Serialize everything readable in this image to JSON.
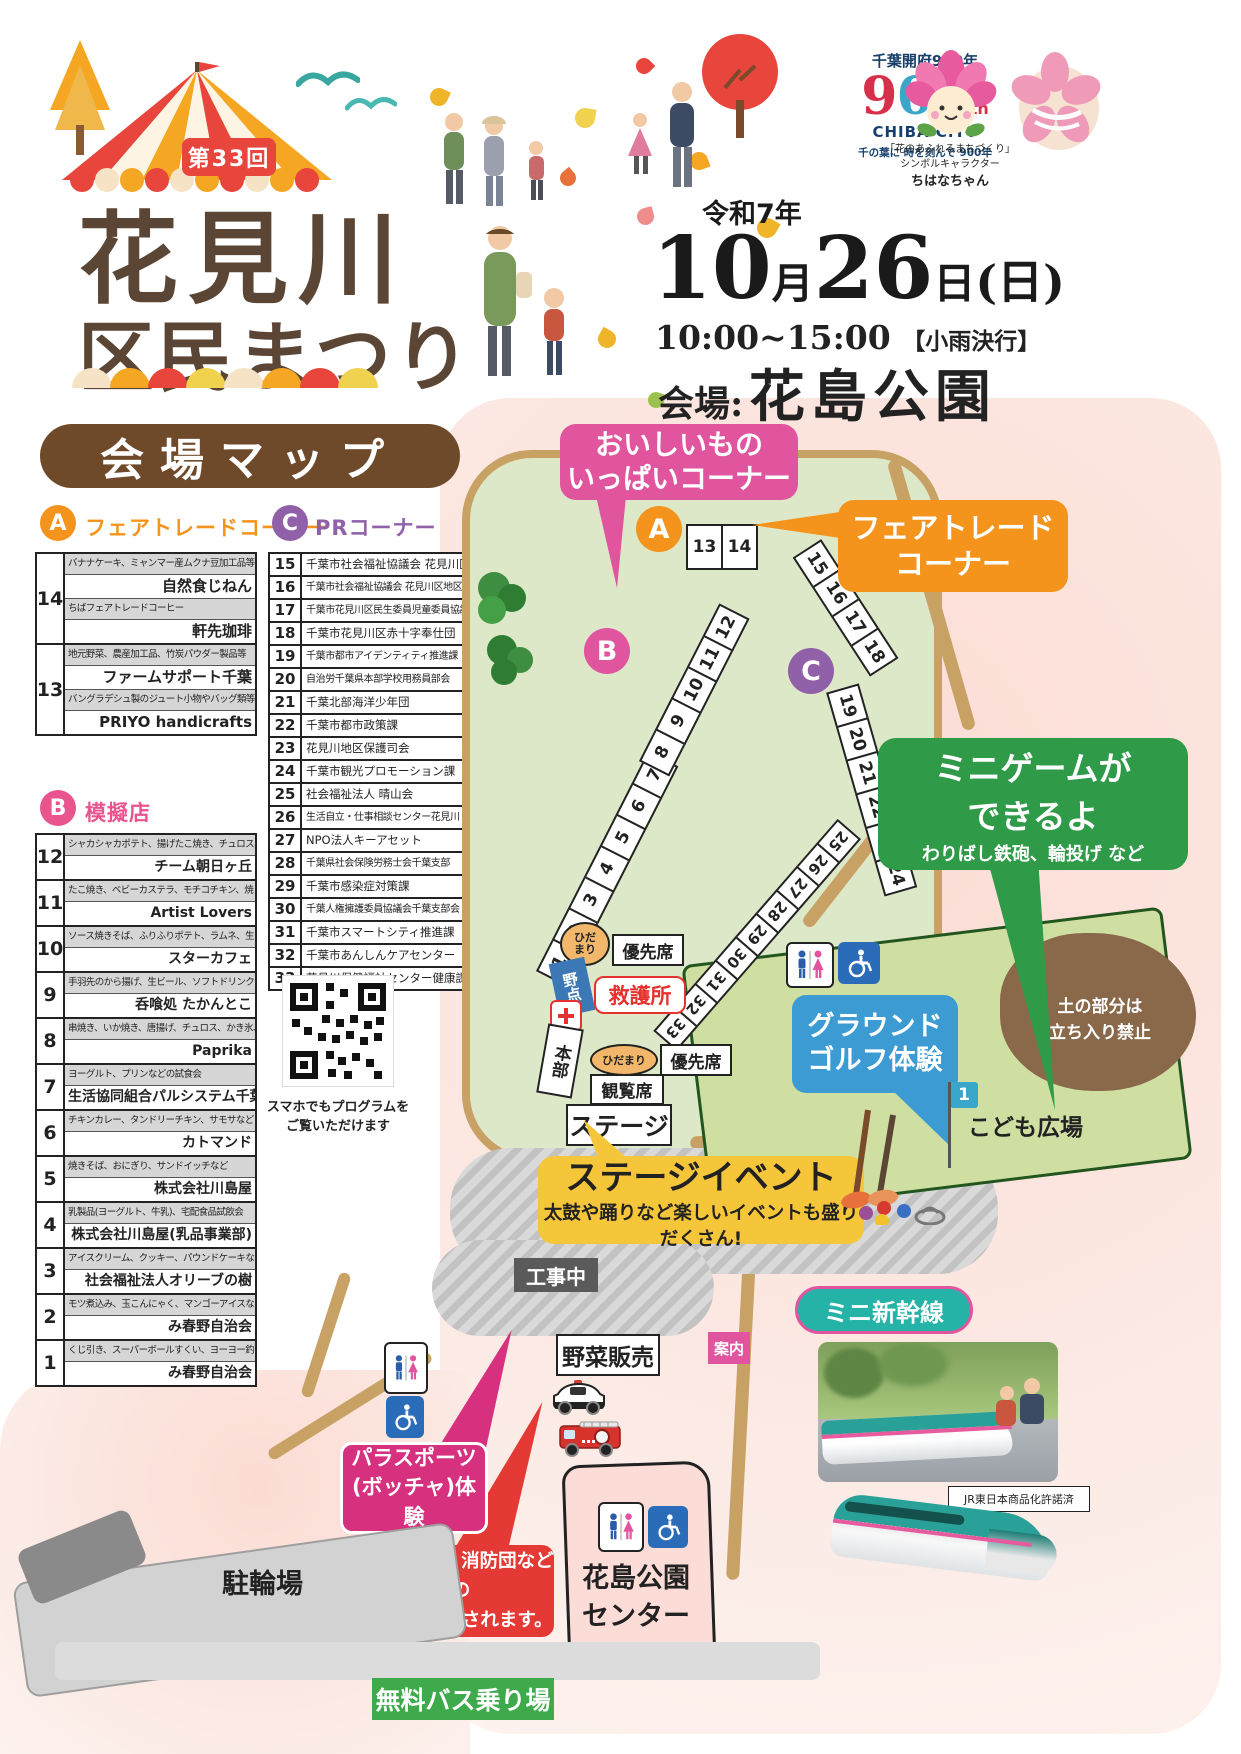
{
  "header": {
    "edition_badge": "第33回",
    "title_line1": "花見川",
    "title_line2": "区民まつり",
    "era_year": "令和7年",
    "date_month": "10",
    "month_unit": "月",
    "date_day": "26",
    "day_unit": "日",
    "weekday": "(日)",
    "time": "10:00~15:00",
    "time_note": "【小雨決行】",
    "venue_prefix": "会場:",
    "venue_name": "花島公園",
    "chiba900": {
      "line1": "千葉開府900年",
      "nine": "9",
      "zero1": "0",
      "zero2": "0",
      "th": "th",
      "city": "CHIBA CITY",
      "tagline": "千の葉に 時を刻んで 900年"
    },
    "mascot": {
      "caption1": "「花のあふれるまちづくり」",
      "caption2": "シンボルキャラクター",
      "name": "ちはなちゃん"
    }
  },
  "map_title": "会場マップ",
  "section_a": {
    "badge": "A",
    "title": "フェアトレードコーナー",
    "rows": [
      {
        "no": "14",
        "desc1": "バナナケーキ、ミャンマー産ムクナ豆加工品等",
        "name1": "自然食じねん",
        "desc2": "ちばフェアトレードコーヒー",
        "name2": "軒先珈琲"
      },
      {
        "no": "13",
        "desc1": "地元野菜、農産加工品、竹炭パウダー製品等",
        "name1": "ファームサポート千葉",
        "desc2": "バングラデシュ製のジュート小物やバッグ類等",
        "name2": "PRIYO handicrafts"
      }
    ]
  },
  "section_b": {
    "badge": "B",
    "title": "模擬店",
    "rows": [
      {
        "no": "12",
        "desc": "シャカシャカポテト、揚げたこ焼き、チュロス、焼きそばなど",
        "name": "チーム朝日ヶ丘"
      },
      {
        "no": "11",
        "desc": "たこ焼き、ベビーカステラ、モチコチキン、焼き鳥など",
        "name": "Artist Lovers"
      },
      {
        "no": "10",
        "desc": "ソース焼きそば、ふりふりポテト、ラムネ、生ビールなど",
        "name": "スターカフェ"
      },
      {
        "no": "9",
        "desc": "手羽先のから揚げ、生ビール、ソフトドリンクなど",
        "name": "呑喰処 たかんとこ"
      },
      {
        "no": "8",
        "desc": "串焼き、いか焼き、唐揚げ、チュロス、かき氷、綿菓子など",
        "name": "Paprika"
      },
      {
        "no": "7",
        "desc": "ヨーグルト、プリンなどの試食会",
        "name": "生活協同組合パルシステム千葉"
      },
      {
        "no": "6",
        "desc": "チキンカレー、タンドリーチキン、サモサなど",
        "name": "カトマンド"
      },
      {
        "no": "5",
        "desc": "焼きそば、おにぎり、サンドイッチなど",
        "name": "株式会社川島屋"
      },
      {
        "no": "4",
        "desc": "乳製品(ヨーグルト、牛乳)、宅配食品試飲会",
        "name": "株式会社川島屋(乳品事業部)"
      },
      {
        "no": "3",
        "desc": "アイスクリーム、クッキー、パウンドケーキなど",
        "name": "社会福祉法人オリーブの樹"
      },
      {
        "no": "2",
        "desc": "モツ煮込み、玉こんにゃく、マンゴーアイスなど",
        "name": "み春野自治会"
      },
      {
        "no": "1",
        "desc": "くじ引き、スーパーボールすくい、ヨーヨー釣り、お菓子",
        "name": "み春野自治会"
      }
    ]
  },
  "section_c": {
    "badge": "C",
    "title": "PRコーナー",
    "rows": [
      {
        "no": "15",
        "name": "千葉市社会福祉協議会 花見川区事務所"
      },
      {
        "no": "16",
        "name": "千葉市社会福祉協議会 花見川区地区部会連絡会"
      },
      {
        "no": "17",
        "name": "千葉市花見川区民生委員児童委員協議会"
      },
      {
        "no": "18",
        "name": "千葉市花見川区赤十字奉仕団"
      },
      {
        "no": "19",
        "name": "千葉市都市アイデンティティ推進課"
      },
      {
        "no": "20",
        "name": "自治労千葉県本部学校用務員部会"
      },
      {
        "no": "21",
        "name": "千葉北部海洋少年団"
      },
      {
        "no": "22",
        "name": "千葉市都市政策課"
      },
      {
        "no": "23",
        "name": "花見川地区保護司会"
      },
      {
        "no": "24",
        "name": "千葉市観光プロモーション課"
      },
      {
        "no": "25",
        "name": "社会福祉法人 晴山会"
      },
      {
        "no": "26",
        "name": "生活自立・仕事相談センター花見川"
      },
      {
        "no": "27",
        "name": "NPO法人キーアセット"
      },
      {
        "no": "28",
        "name": "千葉県社会保険労務士会千葉支部"
      },
      {
        "no": "29",
        "name": "千葉市感染症対策課"
      },
      {
        "no": "30",
        "name": "千葉人権擁護委員協議会千葉支部会"
      },
      {
        "no": "31",
        "name": "千葉市スマートシティ推進課"
      },
      {
        "no": "32",
        "name": "千葉市あんしんケアセンター"
      },
      {
        "no": "33",
        "name": "花見川保健福祉センター健康課"
      }
    ]
  },
  "qr": {
    "line1": "スマホでもプログラムを",
    "line2": "ご覧いただけます"
  },
  "map": {
    "callouts": {
      "oishii": {
        "line1": "おいしいもの",
        "line2": "いっぱいコーナー"
      },
      "fairtrade": {
        "line1": "フェアトレード",
        "line2": "コーナー"
      },
      "minigame": {
        "line1": "ミニゲームが",
        "line2": "できるよ",
        "sub": "わりばし鉄砲、輪投げ など"
      },
      "groundgolf": {
        "line1": "グラウンド",
        "line2": "ゴルフ体験"
      },
      "stage_event": {
        "title": "ステージイベント",
        "sub": "太鼓や踊りなど楽しいイベントも盛りだくさん!"
      },
      "mini_shinkansen": "ミニ新幹線",
      "parasports": {
        "line1": "パラスポーツ",
        "line2": "(ボッチャ)体験"
      },
      "vehicles": {
        "line1": "パトカー、消防団などの",
        "line2": "車両が展示されます。"
      }
    },
    "labels": {
      "stage": "ステージ",
      "kanranseki": "観覧席",
      "honbu": "本部",
      "kyugosho": "救護所",
      "nodate": "野点",
      "hidamari": "ひだまり",
      "yusenseki": "優先席",
      "kojichu": "工事中",
      "yasai_hanbai": "野菜販売",
      "kodomo_hiroba": "こども広場",
      "tsuchi1": "土の部分は",
      "tsuchi2": "立ち入り禁止",
      "annai": "案内",
      "churinjo": "駐輪場",
      "center1": "花島公園",
      "center2": "センター",
      "bus": "無料バス乗り場",
      "jr": "JR東日本商品化許諾済",
      "flag_no": "1"
    },
    "booth_strips": {
      "a": [
        "13",
        "14"
      ],
      "b_lower": [
        "1",
        "2",
        "3",
        "4",
        "5",
        "6",
        "7"
      ],
      "b_upper": [
        "8",
        "9",
        "10",
        "11",
        "12"
      ],
      "c1": [
        "15",
        "16",
        "17",
        "18"
      ],
      "c2": [
        "19",
        "20",
        "21",
        "22",
        "23",
        "24"
      ],
      "c3": [
        "25",
        "26",
        "27",
        "28",
        "29",
        "30",
        "31",
        "32",
        "33"
      ]
    },
    "markers": {
      "a": "A",
      "b": "B",
      "c": "C"
    }
  },
  "colors": {
    "accent_orange": "#f5941d",
    "accent_pink": "#e0559e",
    "accent_purple": "#9060a8",
    "callout_green": "#2f9a47",
    "callout_blue": "#3d9bd3",
    "callout_yellow": "#f6c63a",
    "callout_red": "#e53935",
    "callout_magenta": "#d6307e",
    "teal": "#26b3a7",
    "title_brown": "#6f4a2a",
    "badge_red": "#e8453c"
  }
}
